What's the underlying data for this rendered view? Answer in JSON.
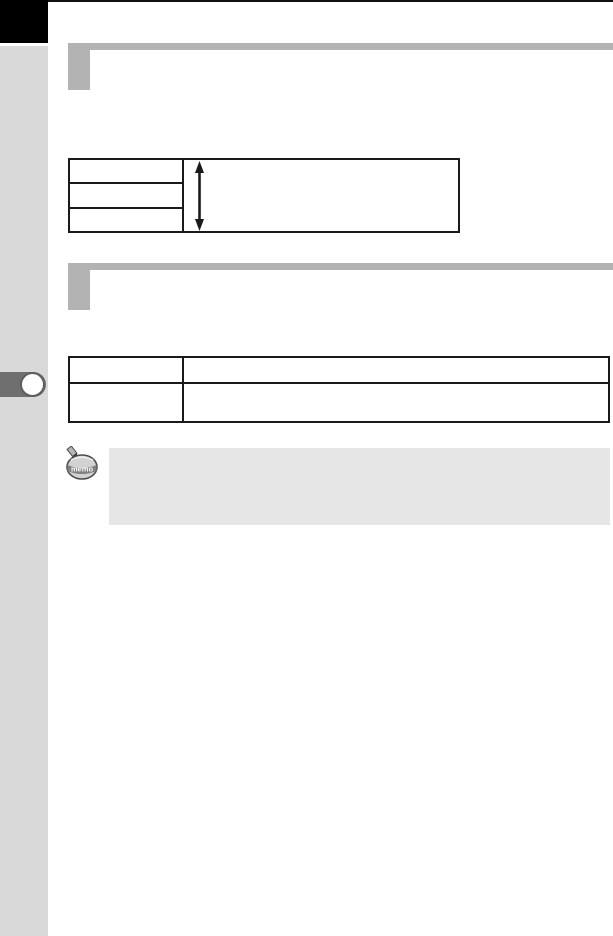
{
  "page": {
    "bg_color": "#ffffff",
    "top_rule_color": "#111111"
  },
  "sidebar": {
    "bg_color": "#d9d9d9",
    "chapter_tab_color": "#000000",
    "chapter_marker": {
      "tab_color": "#6f6f6f",
      "dot_color": "#ffffff",
      "dot_ring_color": "#5e5e5e"
    }
  },
  "section_headers": [
    {
      "title": "",
      "accent_color": "#b3b3b3"
    },
    {
      "title": "",
      "accent_color": "#b3b3b3"
    }
  ],
  "tables": {
    "border_color": "#1a1a1a",
    "range_table": {
      "left_rows": [
        "",
        "",
        ""
      ],
      "value_cell": "",
      "value_icon": "vertical-double-arrow-icon"
    },
    "info_table": {
      "rows": [
        {
          "label": "",
          "value": ""
        },
        {
          "label": "",
          "value": ""
        }
      ]
    }
  },
  "memo": {
    "icon_label": "memo",
    "note_box_color": "#e6e6e6",
    "note_text": ""
  }
}
